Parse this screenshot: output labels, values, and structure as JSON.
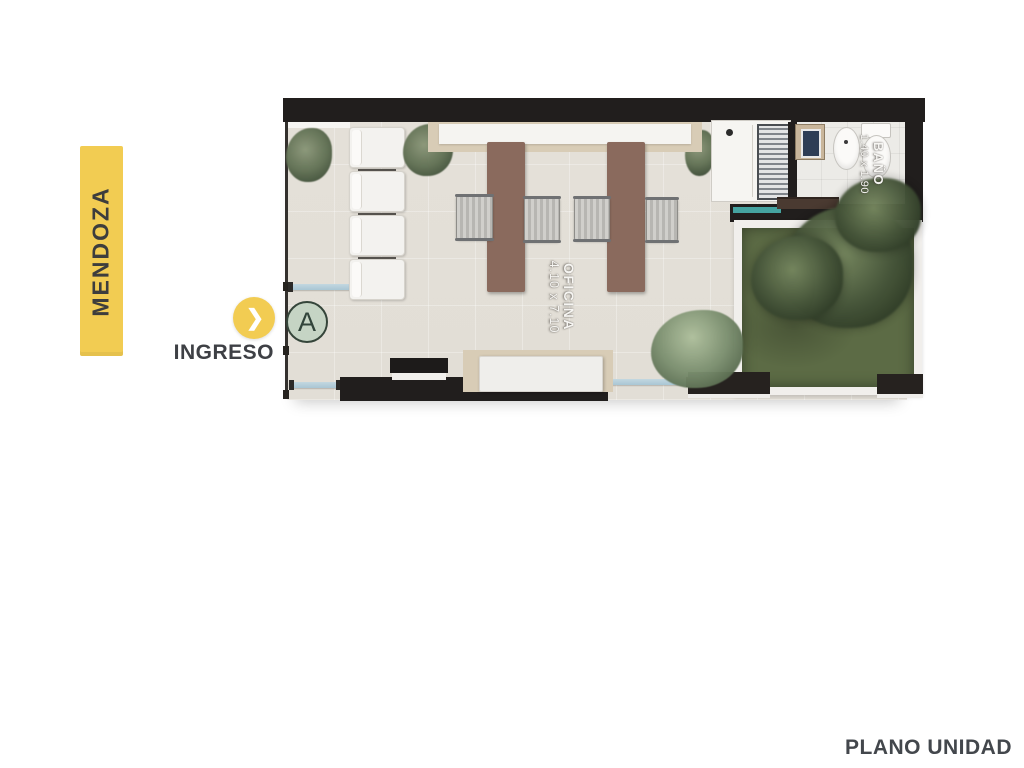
{
  "banner": {
    "label": "MENDOZA"
  },
  "entrance": {
    "label": "INGRESO",
    "chevron": "❯"
  },
  "unit": {
    "letter": "A"
  },
  "plan": {
    "rooms": [
      {
        "id": "oficina",
        "name": "OFICINA",
        "dimensions": "4.10 x 7.10"
      },
      {
        "id": "bano",
        "name": "BAÑO",
        "dimensions": "1.40 x 1.90"
      }
    ]
  },
  "footer": {
    "label": "PLANO UNIDAD"
  },
  "colors": {
    "accent-yellow": "#F2CC52",
    "wall-dark": "#211E1D",
    "floor-beige": "#E2DED6",
    "desk-wood": "#8A6A5D",
    "lawn-green": "#5C6B45",
    "glass-blue": "#A9C6D4",
    "marker-green": "#C5D4C4",
    "teal-accent": "#45A3A0",
    "tan-wood": "#D8CCB6",
    "plant-green": "#5F6F52",
    "text-dark": "#3E4045",
    "label-white": "#F6F5F2"
  }
}
